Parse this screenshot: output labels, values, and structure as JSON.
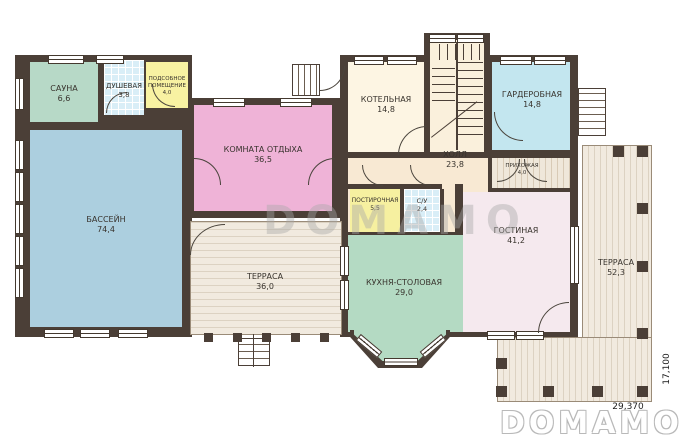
{
  "watermark": "DOMAMO",
  "brand_logo": "DOMAMO",
  "dimensions": {
    "bottom": "29,370",
    "right": "17,100"
  },
  "rooms": {
    "sauna": {
      "name": "САУНА",
      "area": "6,6"
    },
    "shower": {
      "name": "ДУШЕВАЯ",
      "area": "3,8"
    },
    "utility": {
      "name": "ПОДСОБНОЕ ПОМЕЩЕНИЕ",
      "area": "4,0"
    },
    "pool": {
      "name": "БАССЕЙН",
      "area": "74,4"
    },
    "lounge": {
      "name": "КОМНАТА ОТДЫХА",
      "area": "36,5"
    },
    "terrace_left": {
      "name": "ТЕРРАСА",
      "area": "36,0"
    },
    "boiler": {
      "name": "КОТЕЛЬНАЯ",
      "area": "14,8"
    },
    "hall": {
      "name": "ХОЛЛ",
      "area": "23,8"
    },
    "wardrobe": {
      "name": "ГАРДЕРОБНАЯ",
      "area": "14,8"
    },
    "entry": {
      "name": "ПРИХОЖАЯ",
      "area": "4,0"
    },
    "laundry": {
      "name": "ПОСТИРОЧНАЯ",
      "area": "5,5"
    },
    "wc": {
      "name": "С/У",
      "area": "2,4"
    },
    "kitchen": {
      "name": "КУХНЯ-СТОЛОВАЯ",
      "area": "29,0"
    },
    "living": {
      "name": "ГОСТИНАЯ",
      "area": "41,2"
    },
    "terrace_right": {
      "name": "ТЕРРАСА",
      "area": "52,3"
    }
  },
  "colors": {
    "wall": "#4b3f37",
    "pool": "#accfdf",
    "lounge": "#efb3d7",
    "kitchen": "#b4dac3",
    "living": "#f5e9ee",
    "sauna": "#b7d9c7",
    "boiler": "#fdf5e3",
    "hall": "#f8e9d3",
    "wardrobe": "#c3e6ef",
    "laundry": "#f6f0a0",
    "utility": "#f8f2a2",
    "tile": "#d9eef7",
    "terrace": "#f1eadf"
  }
}
